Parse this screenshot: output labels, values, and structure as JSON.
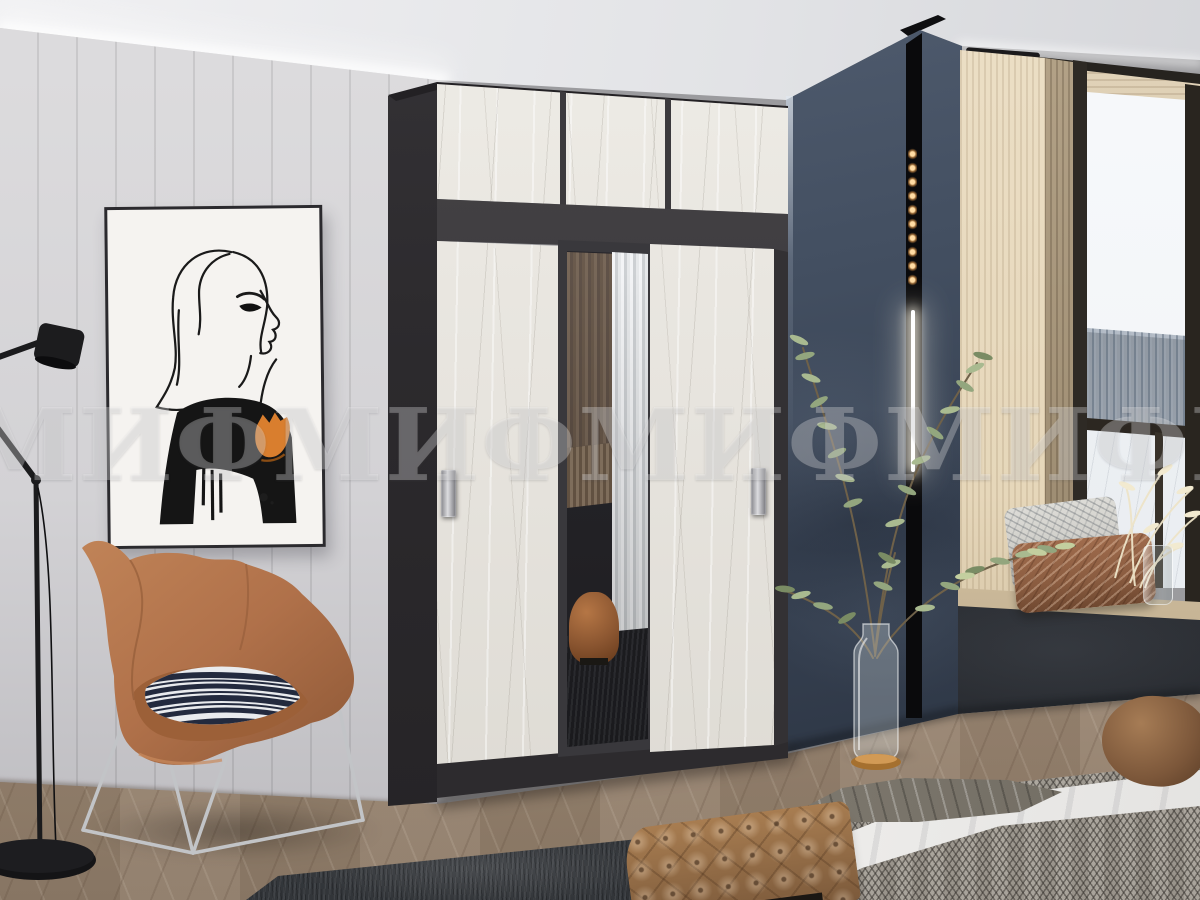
{
  "meta": {
    "kind": "furniture-product-photo",
    "subject": "bedroom interior with two-tone sliding-door wardrobe"
  },
  "watermark": {
    "text": "МИФ"
  },
  "scene": {
    "objects": [
      {
        "name": "sliding-door-wardrobe",
        "desc": "graphite wardrobe with white craft-oak sliding doors, central mirror door and mezzanine top cabinet",
        "colors": [
          "#39383c",
          "#e9e6e0"
        ]
      },
      {
        "name": "wall-art",
        "desc": "framed ink sketch of a woman with an orange cuff",
        "accent": "#d97e2e"
      },
      {
        "name": "accent-armchair",
        "desc": "terracotta wing lounge chair with zebra-stripe pillow and chrome wire base",
        "color": "#b5764a"
      },
      {
        "name": "floor-lamp",
        "desc": "black articulated floor lamp",
        "color": "#1c1c1e"
      },
      {
        "name": "plant",
        "desc": "tall green branches in a glass bottle vase with brass base"
      },
      {
        "name": "window",
        "desc": "wood-framed window with snowy winter view"
      },
      {
        "name": "window-seat",
        "desc": "wood bench seat with grey and terracotta pillows and dried flowers in glass vase"
      },
      {
        "name": "bed",
        "desc": "white sheet, grey herringbone blanket, brown bolster pillow"
      },
      {
        "name": "tufted-bench",
        "desc": "camel button-tufted bench at foot of bed",
        "color": "#8f6a47"
      },
      {
        "name": "rug",
        "desc": "charcoal rug on herringbone wood floor",
        "color": "#43464a"
      },
      {
        "name": "accent-wall",
        "desc": "dark slate plaster wall with vertical LED track light",
        "led_warm": "#f0b46a"
      }
    ],
    "palette": {
      "wall_left": "#d3d2d5",
      "wall_accent": "#3e4a5c",
      "wardrobe_dark": "#39383c",
      "wardrobe_light": "#e9e6e0",
      "floor": "#a08d7a",
      "chair": "#b5764a",
      "led_warm": "#f0b46a"
    }
  }
}
